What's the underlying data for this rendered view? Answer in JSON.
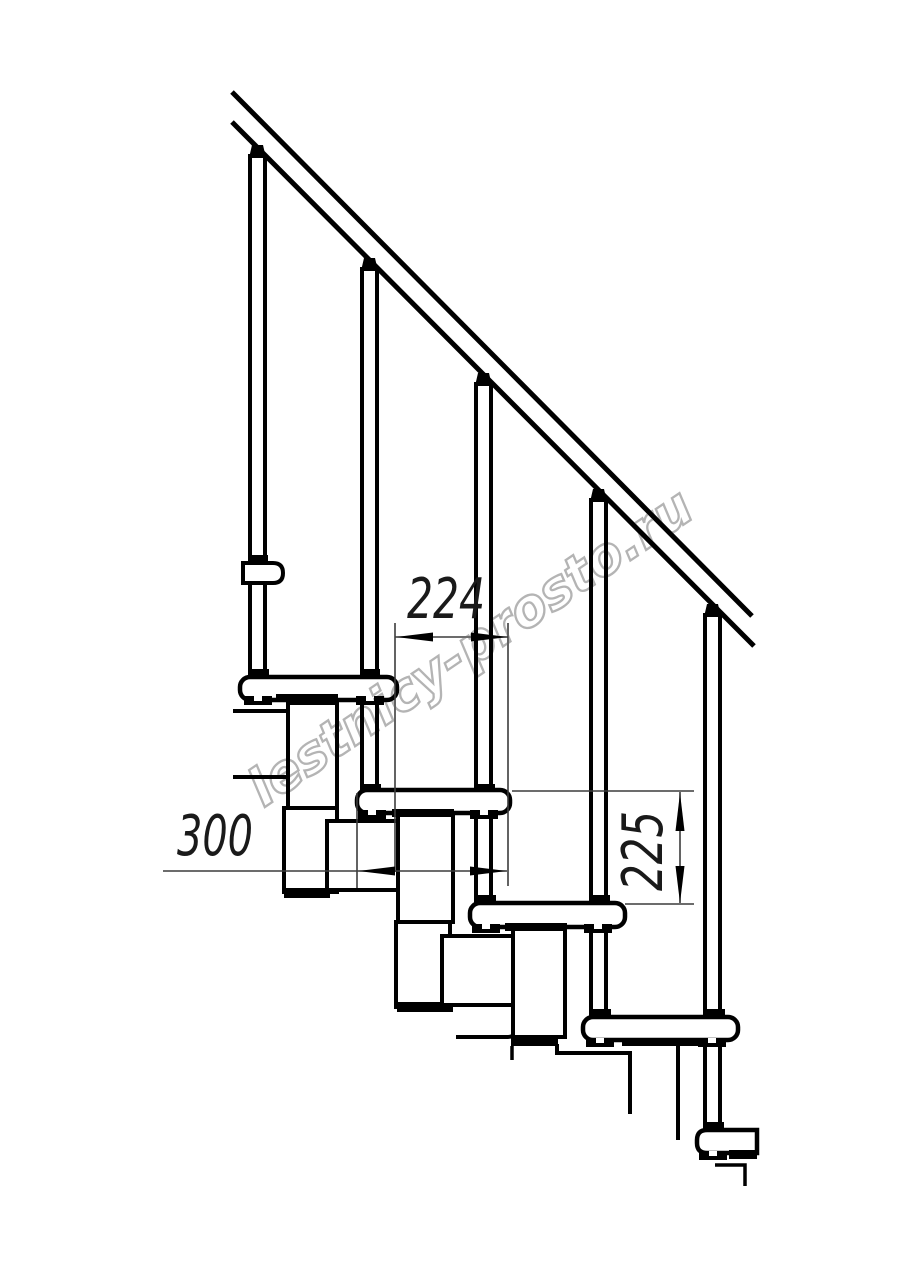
{
  "watermark": {
    "text": "lestnicy-prosto.ru",
    "color": "#b4b4b4"
  },
  "dimensions": {
    "tread_depth": {
      "label": "300",
      "value_mm": 300,
      "meaning": "tread depth"
    },
    "going": {
      "label": "224",
      "value_mm": 224,
      "meaning": "horizontal step run between treads"
    },
    "riser": {
      "label": "225",
      "value_mm": 225,
      "meaning": "riser height between treads"
    }
  },
  "style": {
    "ink": "#000000",
    "background": "#ffffff",
    "thin_line": "#3c3c3c"
  }
}
